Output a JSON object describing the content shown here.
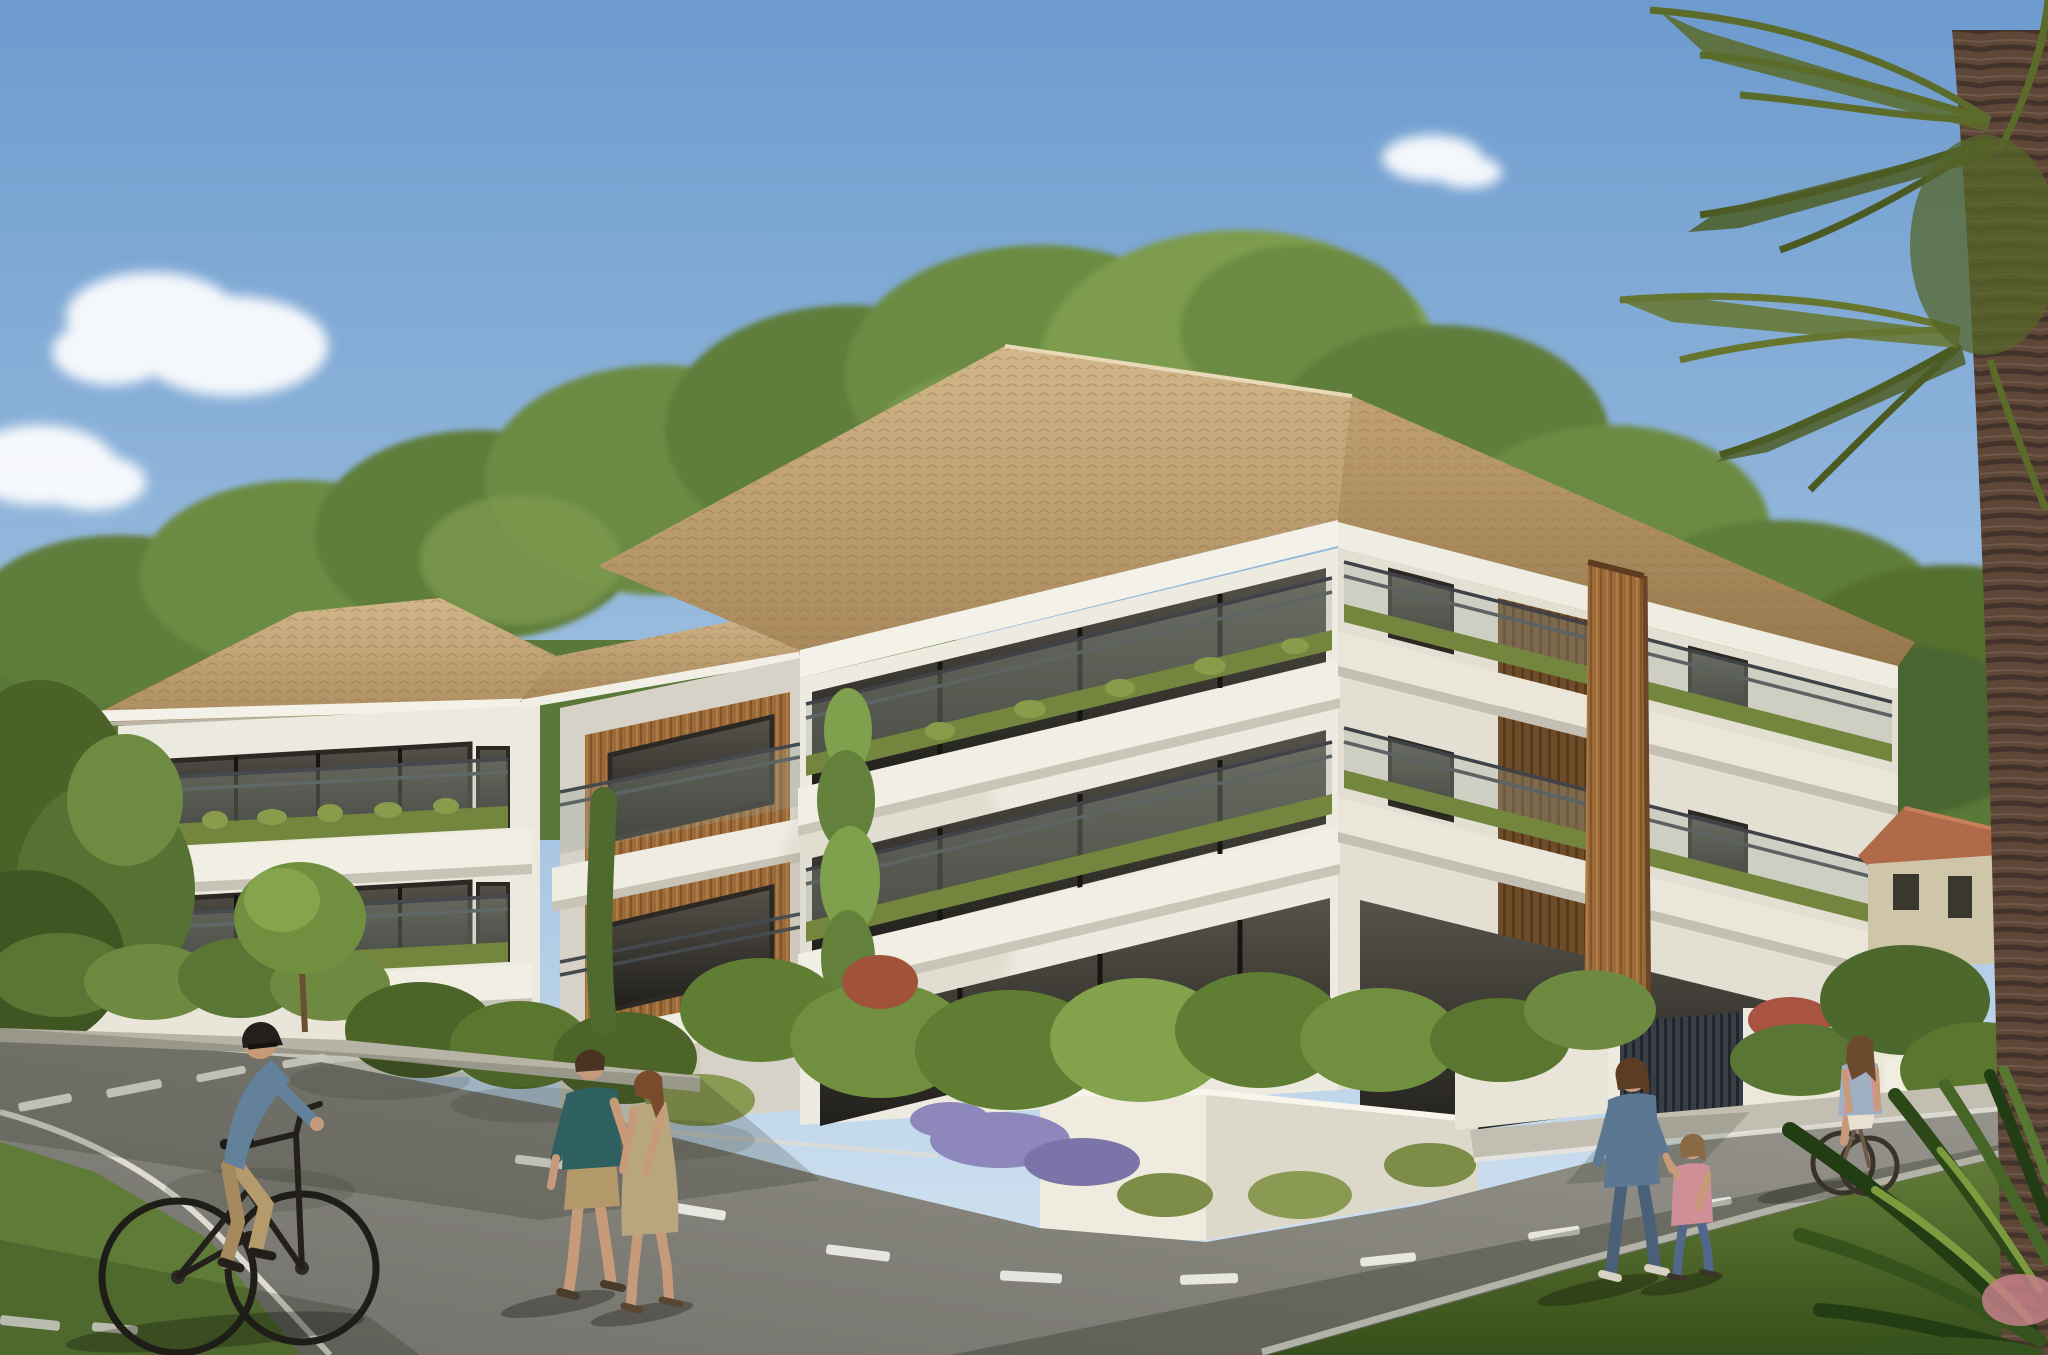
{
  "scene": {
    "kind": "architectural-rendering",
    "subject": "modern 3-storey white apartment residence with planted balconies and tiled hip roofs",
    "time_of_day": "sunny afternoon, clear sky",
    "camera": "street-level three-quarter view from road intersection",
    "no_visible_text": true
  },
  "palette": {
    "sky_top": "#6d9bce",
    "sky_mid": "#9fc0e0",
    "sky_horizon": "#d9e8f3",
    "cloud": "#ffffff",
    "tree_dark": "#4a6530",
    "tree_mid": "#5f7d3a",
    "tree_light": "#7d9c4e",
    "roof_light": "#d3b78a",
    "roof_dark": "#a9895c",
    "roof_right_light": "#c2a274",
    "roof_right_dark": "#96774b",
    "facade_front": "#edeadf",
    "facade_right": "#e3dfd2",
    "facade_recessed": "#e4e0d4",
    "slab_white": "#f1eee4",
    "fascia_white": "#f4f1e8",
    "wood_accent": "#9a6a3a",
    "wood_dark": "#6f4c28",
    "glass_dark": "#211f1b",
    "railing_metal": "#3f4348",
    "planter_grass": "#74863e",
    "wall_white": "#e9e6d9",
    "wall_shadow": "#cfccbe",
    "gate_metal": "#383e45",
    "road_light": "#9a988f",
    "road_dark": "#71706a",
    "road_marking": "#f0efe9",
    "verge_light": "#83a24a",
    "verge_dark": "#43611f",
    "grass_left": "#5e7c37",
    "palm_frond": "#5a6b2a",
    "palm_trunk": "#5e4736",
    "house_roof": "#b06a4a",
    "house_wall": "#cfc6aa",
    "skin": "#c79b7a",
    "cyclist_shirt": "#64819c",
    "cyclist_pants": "#b59a6b",
    "man_shirt_teal": "#2e6060",
    "man_shorts": "#b3986a",
    "woman_dress_tan": "#b8a77e",
    "mother_denim": "#5b7792",
    "jeans": "#4a6078",
    "child_pink": "#cf8f97",
    "girl_top_blue": "#9fb0c2",
    "hair_brown": "#4a3320",
    "hair_auburn": "#7a4a2c",
    "shadow_cast": "#151d10"
  },
  "buildings": {
    "main_block": {
      "storeys": 3,
      "features": [
        "tan roman-tile hip roof",
        "white stucco",
        "wrap-around corner balconies",
        "glass balustrades with steel handrails",
        "grass planter edges",
        "vertical timber slat column",
        "recessed timber-clad bay",
        "dark aluminium window frames"
      ]
    },
    "left_block": {
      "storeys": 2,
      "features": [
        "hip tile roof",
        "two balcony levels",
        "narrow side windows"
      ]
    },
    "background_house": {
      "storeys": 1,
      "features": [
        "beige cottage",
        "terracotta gable roof",
        "three small dark openings"
      ]
    }
  },
  "vegetation": {
    "roof_treeline": "dense green canopy behind and above roofline",
    "palm": "tall fan palm, fronds top-right, trunk along right edge",
    "foreground": [
      "wild shrub beds",
      "lavender patches",
      "rust-red flowering bushes",
      "young poplar sapling",
      "cypress",
      "yucca fans bottom-right",
      "grass verges"
    ]
  },
  "street": {
    "surfaces": [
      "asphalt junction",
      "white edge lines",
      "dashed centre line",
      "concrete sidewalks",
      "low white garden walls",
      "dark slatted gate"
    ],
    "dash_count": 14,
    "shadow": "long building shadow across lower-right road and verge"
  },
  "people": [
    {
      "id": "cyclist-left",
      "desc": "man on bicycle, dark cap, blue-grey shirt, khaki trousers, riding right"
    },
    {
      "id": "walking-man",
      "desc": "man in teal t-shirt and khaki shorts, walking away"
    },
    {
      "id": "walking-woman",
      "desc": "woman in tan sleeveless dress, auburn hair, walking away"
    },
    {
      "id": "mother",
      "desc": "woman in denim top and jeans holding child's hand"
    },
    {
      "id": "child",
      "desc": "small girl in pink top and jeans"
    },
    {
      "id": "girl-cyclist",
      "desc": "girl in light blue top riding bicycle away on right road"
    }
  ],
  "clouds": 4
}
